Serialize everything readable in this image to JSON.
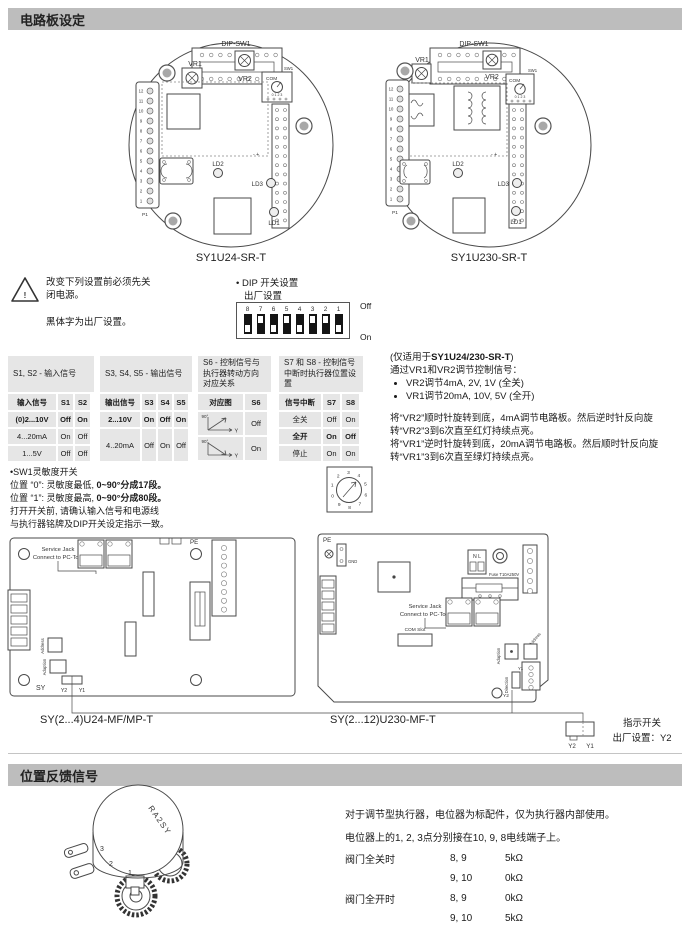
{
  "section1": {
    "title": "电路板设定"
  },
  "section2": {
    "title": "位置反馈信号"
  },
  "boards_upper": {
    "left": {
      "caption": "SY1U24-SR-T",
      "dip_label": "DIP-SW1",
      "vr1": "VR1",
      "vr2": "VR2",
      "sw_label": "SW1",
      "com": "COM",
      "rotary_digits_row": "0 1 2 3",
      "p1": "P1",
      "ld1": "LD1",
      "ld2": "LD2",
      "ld3": "LD3",
      "polarity": "- +",
      "pin_numbers": [
        "12",
        "11",
        "10",
        "9",
        "8",
        "7",
        "6",
        "5",
        "4",
        "3",
        "2",
        "1"
      ]
    },
    "right": {
      "caption": "SY1U230-SR-T",
      "dip_label": "DIP-SW1",
      "vr1": "VR1",
      "vr2": "VR2",
      "sw_label": "SW1",
      "com": "COM",
      "rotary_digits_row": "0 1 2 3",
      "p1": "P1",
      "ld1": "LD1",
      "ld2": "LD2",
      "ld3": "LD3",
      "polarity": "- +",
      "pin_numbers": [
        "12",
        "11",
        "10",
        "9",
        "8",
        "7",
        "6",
        "5",
        "4",
        "3",
        "2",
        "1"
      ]
    }
  },
  "warning": {
    "line1": "改变下列设置前必须先关",
    "line2": "闭电源。",
    "line3": "黑体字为出厂设置。"
  },
  "dip_factory": {
    "title": "• DIP 开关设置",
    "subtitle": "出厂设置",
    "numbers": [
      "8",
      "7",
      "6",
      "5",
      "4",
      "3",
      "2",
      "1"
    ],
    "positions": [
      "off",
      "on",
      "off",
      "on",
      "off",
      "on",
      "on",
      "off"
    ],
    "off_label": "Off",
    "on_label": "On"
  },
  "tables": [
    {
      "title": "S1, S2 - 输入信号",
      "headers": [
        "输入信号",
        "S1",
        "S2"
      ],
      "rows": [
        {
          "cells": [
            "(0)2...10V",
            "Off",
            "On"
          ],
          "bold": true
        },
        {
          "cells": [
            "4...20mA",
            "On",
            "Off"
          ],
          "bold": false
        },
        {
          "cells": [
            "1...5V",
            "Off",
            "Off"
          ],
          "bold": false
        }
      ]
    },
    {
      "title": "S3, S4, S5 - 输出信号",
      "headers": [
        "输出信号",
        "S3",
        "S4",
        "S5"
      ],
      "rows": [
        {
          "cells": [
            "2...10V",
            "On",
            "Off",
            "On"
          ],
          "bold": true
        },
        {
          "cells": [
            "4..20mA",
            "Off",
            "On",
            "Off"
          ],
          "bold": false
        }
      ]
    },
    {
      "title": "S6 - 控制信号与执行器转动方向对应关系",
      "headers": [
        "对应图",
        "S6"
      ],
      "axis_label": "90°",
      "arrow_label": "Y",
      "rows": [
        {
          "graph": "rising",
          "cells": [
            "Off"
          ],
          "bold": false
        },
        {
          "graph": "falling",
          "cells": [
            "On"
          ],
          "bold": false
        }
      ]
    },
    {
      "title": "S7 和 S8 - 控制信号中断时执行器位置设置",
      "headers": [
        "信号中断",
        "S7",
        "S8"
      ],
      "rows": [
        {
          "cells": [
            "全关",
            "Off",
            "On"
          ],
          "bold": false
        },
        {
          "cells": [
            "全开",
            "On",
            "Off"
          ],
          "bold": true
        },
        {
          "cells": [
            "停止",
            "On",
            "On"
          ],
          "bold": false
        }
      ]
    }
  ],
  "vr_note": {
    "title_prefix": "(仅适用于",
    "title_bold": "SY1U24/230-SR-T",
    "title_suffix": ")",
    "line1": "通过VR1和VR2调节控制信号：",
    "bullet1": "VR2调节4mA, 2V, 1V (全关)",
    "bullet2": "VR1调节20mA, 10V, 5V (全开)",
    "para1": "将“VR2”顺时针旋转到底，4mA调节电路板。然后逆时针反向旋转“VR2”3到6次直至红灯持续点亮。",
    "para2": "将“VR1”逆时针旋转到底，20mA调节电路板。然后顺时针反向旋转“VR1”3到6次直至绿灯持续点亮。"
  },
  "sw_note": {
    "line1": "•SW1灵敏度开关",
    "line2_prefix": "位置 “0”: 灵敏度最低, ",
    "line2_bold": "0~90°分成17段。",
    "line3_prefix": "位置 “1”: 灵敏度最高, ",
    "line3_bold": "0~90°分成80段。",
    "line4": "打开开关前, 请确认输入信号和电源线",
    "line5": "与执行器铭牌及DIP开关设定指示一致。",
    "rotary_digits": "0123456789"
  },
  "boards_lower": {
    "left": {
      "caption": "SY(2...4)U24-MF/MP-T",
      "service_jack": "Service Jack",
      "connect": "Connect to PC-Tool",
      "pe": "PE",
      "sy": "SY",
      "y2": "Y2",
      "y1": "Y1",
      "address": "Address",
      "adaption": "Adaption"
    },
    "right": {
      "caption": "SY(2...12)U230-MF-T",
      "pe": "PE",
      "gnd": "GND",
      "nl": "N L",
      "fuse": "Fuse T10A250V",
      "service_jack": "Service Jack",
      "connect": "Connect to PC-Tool",
      "com_slot": "COM Slot",
      "adaption": "Adaption",
      "address": "Address",
      "direction": "Direction",
      "y1": "Y1",
      "y2": "Y2"
    },
    "indicator": {
      "line1": "指示开关",
      "line2": "出厂设置：Y2",
      "y2": "Y2",
      "y1": "Y1"
    }
  },
  "feedback": {
    "pot_label": "RA2SY",
    "pot_numbers": [
      "3",
      "2",
      "1"
    ],
    "line1": "对于调节型执行器，电位器为标配件，仅为执行器内部使用。",
    "line2": "电位器上的1, 2, 3点分别接在10, 9, 8电线端子上。",
    "rows": [
      [
        "阀门全关时",
        "8, 9",
        "5kΩ"
      ],
      [
        "",
        "9, 10",
        "0kΩ"
      ],
      [
        "阀门全开时",
        "8, 9",
        "0kΩ"
      ],
      [
        "",
        "9, 10",
        "5kΩ"
      ]
    ]
  }
}
